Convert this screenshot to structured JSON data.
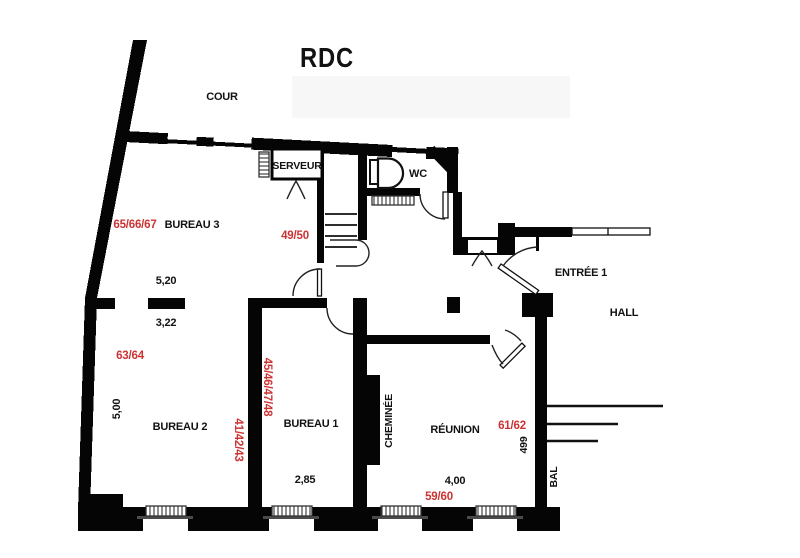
{
  "plan": {
    "title": "RDC",
    "areas": {
      "cour": "COUR",
      "hall": "HALL",
      "bal": "BAL",
      "entree": "ENTRÉE 1"
    },
    "rooms": {
      "bureau3": "BUREAU 3",
      "bureau2": "BUREAU 2",
      "bureau1": "BUREAU 1",
      "reunion": "RÉUNION",
      "serveur": "SERVEUR",
      "wc": "WC",
      "cheminee": "CHEMINÉE"
    },
    "refs": {
      "bureau3": "65/66/67",
      "stair": "49/50",
      "bureau2": "63/64",
      "bureau2_wall": "41/42/43",
      "bureau1": "45/46/47/48",
      "reunion": "61/62",
      "reunion_low": "59/60"
    },
    "dims": {
      "bureau3_w": "5,20",
      "bureau3_opening": "3,22",
      "bureau2_h": "5,00",
      "bureau1_w": "2,85",
      "reunion_w": "4,00",
      "hall": "499"
    },
    "colors": {
      "wall": "#000000",
      "accent": "#cc3333",
      "sill": "#4a4a4a",
      "watermark": "#f7f7f7"
    }
  }
}
